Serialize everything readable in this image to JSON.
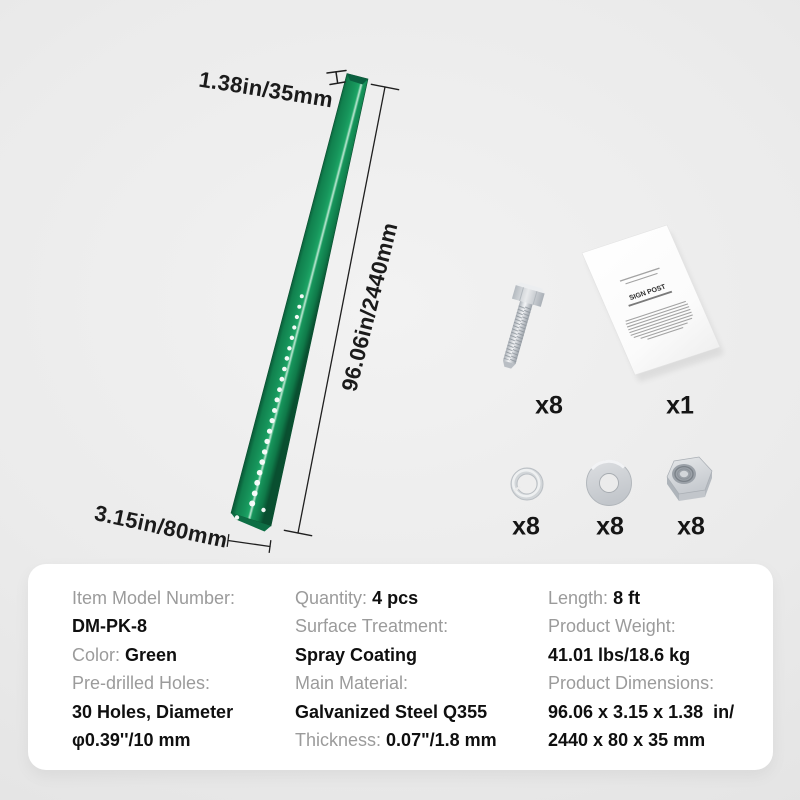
{
  "annotations": {
    "width": "1.38in/35mm",
    "length": "96.06in/2440mm",
    "depth": "3.15in/80mm"
  },
  "kit": {
    "bolt": {
      "count": "x8"
    },
    "manual": {
      "count": "x1",
      "title": "SIGN POST"
    },
    "spring_washer": {
      "count": "x8"
    },
    "flat_washer": {
      "count": "x8"
    },
    "hex_nut": {
      "count": "x8"
    }
  },
  "colors": {
    "post_green": "#17965c",
    "post_green_dark": "#0a5e3a",
    "post_highlight": "#bfe9d4",
    "metal_silver": "#c9cdd2",
    "background": "#ebebeb",
    "panel": "#ffffff",
    "label_gray": "#9b9b9b",
    "text_black": "#0f0f0f"
  },
  "specs": {
    "columns": [
      {
        "rows": [
          {
            "label": "Item Model Number:",
            "value": ""
          },
          {
            "label": "",
            "value": "DM-PK-8"
          },
          {
            "label": "Color:",
            "value": "Green"
          },
          {
            "label": "Pre-drilled Holes:",
            "value": ""
          },
          {
            "label": "",
            "value": "30 Holes, Diameter"
          },
          {
            "label": "",
            "value": "φ0.39''/10 mm"
          }
        ]
      },
      {
        "rows": [
          {
            "label": "Quantity:",
            "value": "4 pcs"
          },
          {
            "label": "Surface Treatment:",
            "value": ""
          },
          {
            "label": "",
            "value": "Spray Coating"
          },
          {
            "label": "Main Material:",
            "value": ""
          },
          {
            "label": "",
            "value": "Galvanized Steel Q355"
          },
          {
            "label": "Thickness:",
            "value": "0.07\"/1.8 mm"
          }
        ]
      },
      {
        "rows": [
          {
            "label": "Length:",
            "value": "8 ft"
          },
          {
            "label": "Product Weight:",
            "value": ""
          },
          {
            "label": "",
            "value": "41.01 lbs/18.6 kg"
          },
          {
            "label": "Product Dimensions:",
            "value": ""
          },
          {
            "label": "",
            "value": "96.06 x 3.15 x 1.38  in/"
          },
          {
            "label": "",
            "value": "2440 x 80 x 35 mm"
          }
        ]
      }
    ]
  }
}
